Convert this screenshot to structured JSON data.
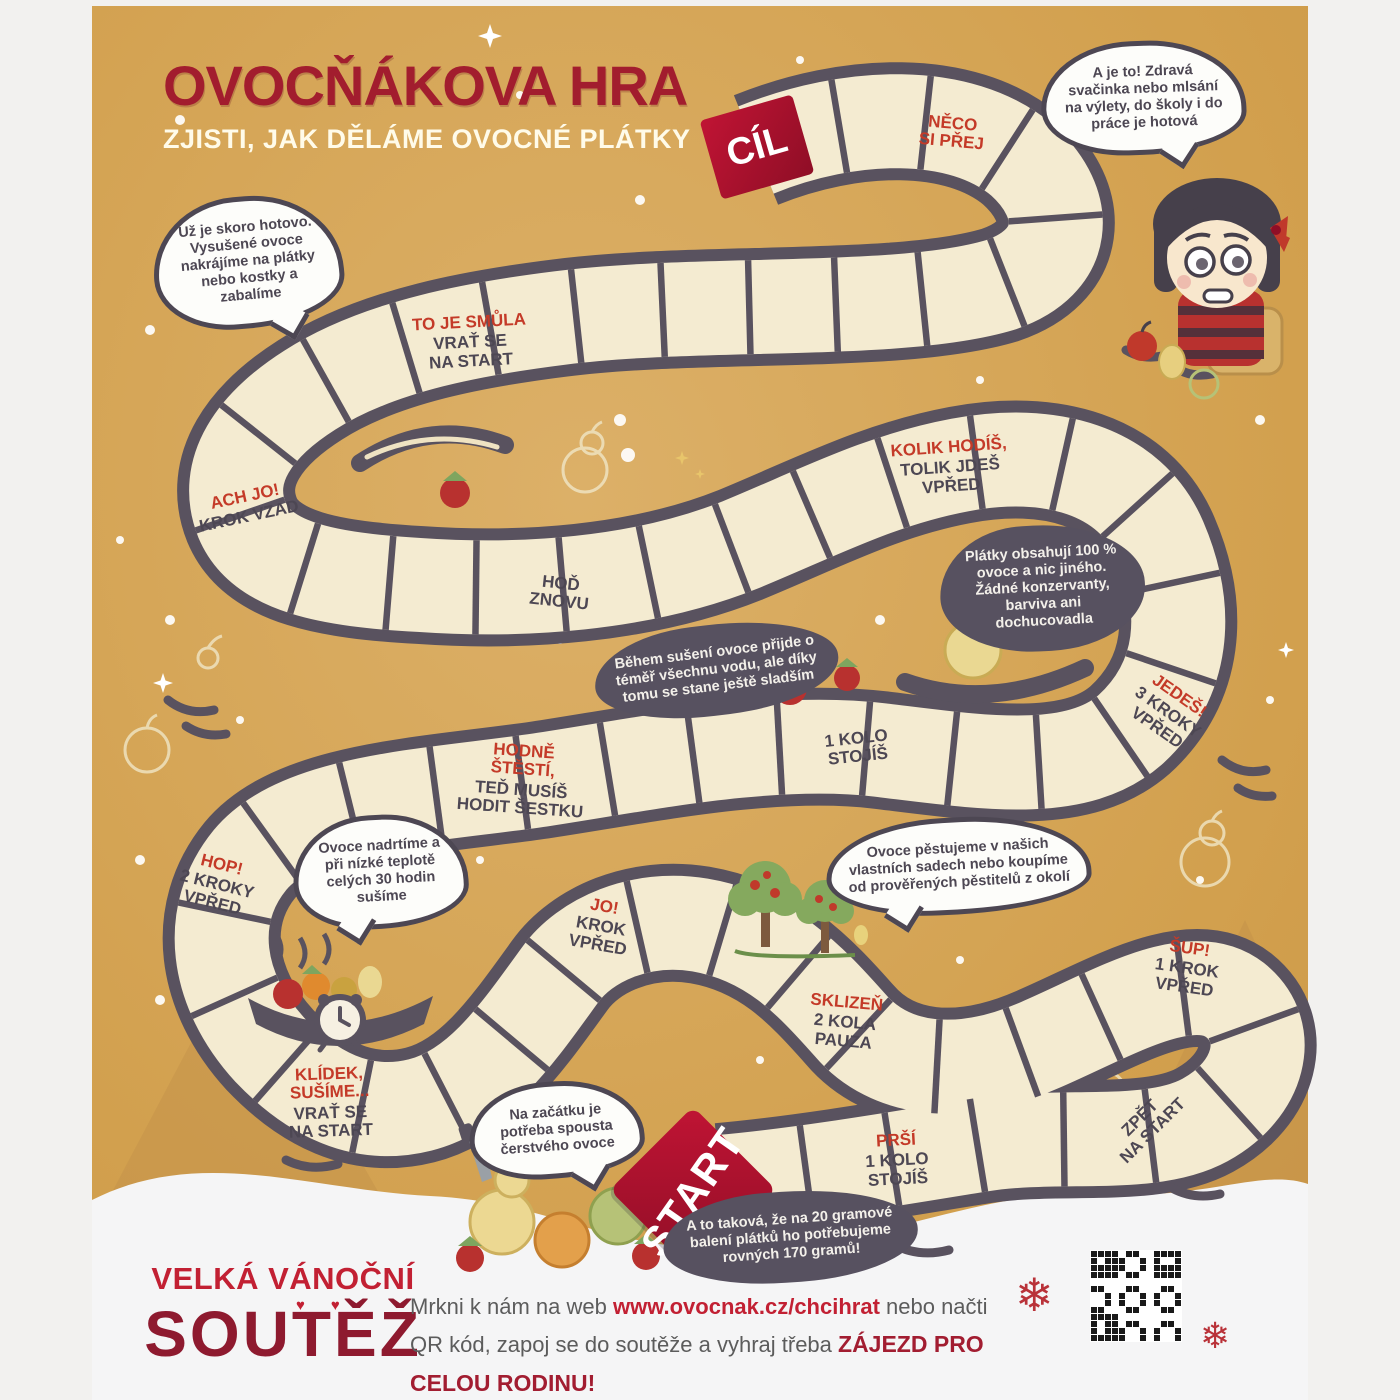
{
  "title": {
    "main": "OVOCŇÁKOVA HRA",
    "subtitle": "ZJISTI, JAK DĚLÁME OVOCNÉ PLÁTKY"
  },
  "board": {
    "cil_label": "CÍL",
    "start_label": "START",
    "tiles": [
      {
        "id": "neco",
        "accent": "NĚCO\nSI PŘEJ",
        "rest": ""
      },
      {
        "id": "smula",
        "accent": "TO JE SMŮLA",
        "rest": "VRAŤ SE\nNA START"
      },
      {
        "id": "achjo",
        "accent": "ACH JO!",
        "rest": "KROK VZAD"
      },
      {
        "id": "hodznovu",
        "accent": "",
        "rest": "HOĎ\nZNOVU"
      },
      {
        "id": "kolik",
        "accent": "KOLIK HODÍŠ,",
        "rest": "TOLIK JDEŠ\nVPŘED"
      },
      {
        "id": "jedes",
        "accent": "JEDEŠ!",
        "rest": "3 KROKY\nVPŘED"
      },
      {
        "id": "kolo1",
        "accent": "",
        "rest": "1 KOLO\nSTOJÍŠ"
      },
      {
        "id": "hodne",
        "accent": "HODNĚ\nŠTĚSTÍ,",
        "rest": "TEĎ MUSÍŠ\nHODIT ŠESTKU"
      },
      {
        "id": "hop",
        "accent": "HOP!",
        "rest": "2 KROKY\nVPŘED"
      },
      {
        "id": "jo",
        "accent": "JO!",
        "rest": "KROK\nVPŘED"
      },
      {
        "id": "sklizen",
        "accent": "SKLIZEŇ",
        "rest": "2 KOLA\nPAUZA"
      },
      {
        "id": "sup",
        "accent": "ŠUP!",
        "rest": "1 KROK\nVPŘED"
      },
      {
        "id": "klidek",
        "accent": "KLÍDEK,\nSUŠÍME...",
        "rest": "VRAŤ SE\nNA START"
      },
      {
        "id": "prsi",
        "accent": "PRŠÍ",
        "rest": "1 KOLO\nSTOJÍŠ"
      },
      {
        "id": "zpet",
        "accent": "",
        "rest": "ZPĚT\nNA START"
      }
    ]
  },
  "bubbles": {
    "light": [
      {
        "id": "b1",
        "text": "Už je skoro hotovo. Vysušené ovoce nakrájíme na plátky nebo kostky a zabalíme"
      },
      {
        "id": "b2",
        "text": "A je to! Zdravá svačinka nebo mlsání na výlety, do školy i do práce je hotová"
      },
      {
        "id": "b3",
        "text": "Ovoce nadrtíme a při nízké teplotě celých 30 hodin sušíme"
      },
      {
        "id": "b4",
        "text": "Ovoce pěstujeme v našich vlastních sadech nebo koupíme od prověřených pěstitelů z okolí"
      },
      {
        "id": "b5",
        "text": "Na začátku je potřeba spousta čerstvého ovoce"
      }
    ],
    "dark": [
      {
        "id": "d1",
        "text": "Plátky obsahují 100 % ovoce a nic jiného. Žádné konzervanty, barviva ani dochucovadla"
      },
      {
        "id": "d2",
        "text": "Během sušení ovoce přijde o téměř všechnu vodu, ale díky tomu se stane ještě sladším"
      },
      {
        "id": "d3",
        "text": "A to taková, že na 20 gramové balení plátků ho potřebujeme rovných 170 gramů!"
      }
    ]
  },
  "footer": {
    "velka": "VELKÁ VÁNOČNÍ",
    "soutez": "SOUTĚŽ",
    "hearts": "♥♥",
    "line1_pre": "Mrkni k nám na web ",
    "link": "www.ovocnak.cz/chcihrat",
    "line1_post": " nebo načti",
    "line2_pre": "QR kód, zapoj se do soutěže a vyhraj třeba ",
    "line2_bold": "ZÁJEZD PRO CELOU RODINU!",
    "snowflake": "❄"
  },
  "colors": {
    "background_tan": "#d5a351",
    "tile_cream": "#f4ebd1",
    "path_dark": "#59525f",
    "accent_red": "#c43a28",
    "brand_dark_red": "#a21d2e",
    "cil_start_red": "#a31127",
    "snow_white": "#f5f5f6"
  }
}
